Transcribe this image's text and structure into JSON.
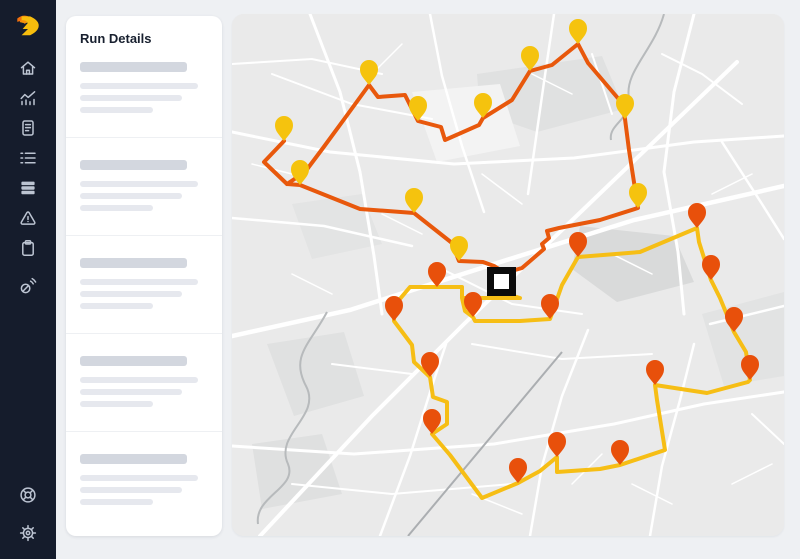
{
  "sidebar": {
    "logo": {
      "name": "brand-logo",
      "color_primary": "#F2700D",
      "color_secondary": "#F7BD0D"
    },
    "nav_items": [
      {
        "id": "home",
        "icon": "home-icon"
      },
      {
        "id": "analytics",
        "icon": "analytics-icon"
      },
      {
        "id": "documents",
        "icon": "document-icon"
      },
      {
        "id": "tasks",
        "icon": "checklist-icon"
      },
      {
        "id": "stack",
        "icon": "layers-icon"
      },
      {
        "id": "alerts",
        "icon": "alert-icon"
      },
      {
        "id": "clipboard",
        "icon": "clipboard-icon"
      },
      {
        "id": "connections",
        "icon": "signal-icon"
      }
    ],
    "footer_items": [
      {
        "id": "help",
        "icon": "help-icon"
      },
      {
        "id": "settings",
        "icon": "gear-icon"
      }
    ]
  },
  "run_details_panel": {
    "title": "Run Details",
    "skeleton": {
      "section_count": 5,
      "header_bar": {
        "width": 107,
        "height": 10,
        "color": "#d3d7df"
      },
      "line_widths": [
        118,
        102,
        73
      ],
      "line_color": "#e6e8ee"
    }
  },
  "map": {
    "background": "#eaeaea",
    "depot_marker": {
      "x": 255,
      "y": 253,
      "size": 29,
      "fill": "#ffffff",
      "border": "#0b0b0b",
      "border_width": 7
    },
    "routes": [
      {
        "id": "route-1",
        "line_color": "#E8580C",
        "pin_color": "#F5C30E",
        "paths": [
          [
            [
              52,
              127
            ],
            [
              32,
              148
            ],
            [
              55,
              170
            ],
            [
              68,
              171
            ],
            [
              128,
              195
            ],
            [
              182,
              199
            ],
            [
              220,
              229
            ],
            [
              227,
              247
            ],
            [
              251,
              248
            ],
            [
              262,
              252
            ],
            [
              270,
              257
            ]
          ],
          [
            [
              55,
              170
            ],
            [
              73,
              158
            ],
            [
              91,
              134
            ],
            [
              113,
              104
            ],
            [
              137,
              71
            ],
            [
              146,
              83
            ],
            [
              173,
              81
            ],
            [
              186,
              107
            ],
            [
              209,
              113
            ],
            [
              213,
              126
            ],
            [
              247,
              111
            ],
            [
              251,
              104
            ],
            [
              280,
              86
            ],
            [
              298,
              57
            ],
            [
              320,
              51
            ],
            [
              346,
              30
            ],
            [
              356,
              49
            ],
            [
              390,
              89
            ],
            [
              393,
              105
            ],
            [
              397,
              136
            ],
            [
              406,
              194
            ],
            [
              368,
              206
            ],
            [
              327,
              214
            ],
            [
              315,
              217
            ],
            [
              317,
              224
            ],
            [
              310,
              230
            ],
            [
              312,
              235
            ],
            [
              290,
              254
            ],
            [
              283,
              256
            ]
          ]
        ],
        "pins": [
          [
            52,
            127
          ],
          [
            68,
            171
          ],
          [
            182,
            199
          ],
          [
            227,
            247
          ],
          [
            137,
            71
          ],
          [
            186,
            107
          ],
          [
            251,
            104
          ],
          [
            298,
            57
          ],
          [
            346,
            30
          ],
          [
            393,
            105
          ],
          [
            406,
            194
          ]
        ]
      },
      {
        "id": "route-2",
        "line_color": "#F6BE15",
        "pin_color": "#E8500B",
        "paths": [
          [
            [
              278,
              281
            ],
            [
              288,
              284
            ],
            [
              230,
              284
            ],
            [
              230,
              273
            ],
            [
              205,
              273
            ],
            [
              178,
              273
            ],
            [
              162,
              292
            ],
            [
              162,
              307
            ],
            [
              180,
              331
            ],
            [
              182,
              348
            ],
            [
              198,
              363
            ],
            [
              201,
              383
            ],
            [
              215,
              388
            ],
            [
              215,
              410
            ],
            [
              200,
              420
            ],
            [
              218,
              441
            ],
            [
              250,
              484
            ],
            [
              286,
              469
            ],
            [
              308,
              457
            ],
            [
              325,
              443
            ],
            [
              325,
              458
            ],
            [
              368,
              455
            ],
            [
              388,
              451
            ],
            [
              433,
              436
            ],
            [
              425,
              386
            ],
            [
              423,
              371
            ],
            [
              475,
              379
            ],
            [
              516,
              368
            ],
            [
              518,
              366
            ],
            [
              514,
              338
            ],
            [
              502,
              318
            ],
            [
              488,
              284
            ],
            [
              479,
              266
            ],
            [
              467,
              228
            ],
            [
              465,
              214
            ],
            [
              408,
              238
            ],
            [
              346,
              243
            ],
            [
              330,
              271
            ],
            [
              318,
              305
            ],
            [
              288,
              307
            ],
            [
              243,
              307
            ],
            [
              241,
              303
            ],
            [
              233,
              297
            ],
            [
              230,
              284
            ]
          ]
        ],
        "pins": [
          [
            205,
            273
          ],
          [
            162,
            307
          ],
          [
            241,
            303
          ],
          [
            318,
            305
          ],
          [
            346,
            243
          ],
          [
            465,
            214
          ],
          [
            479,
            266
          ],
          [
            502,
            318
          ],
          [
            518,
            366
          ],
          [
            423,
            371
          ],
          [
            388,
            451
          ],
          [
            286,
            469
          ],
          [
            325,
            443
          ],
          [
            200,
            420
          ],
          [
            198,
            363
          ]
        ]
      }
    ]
  }
}
